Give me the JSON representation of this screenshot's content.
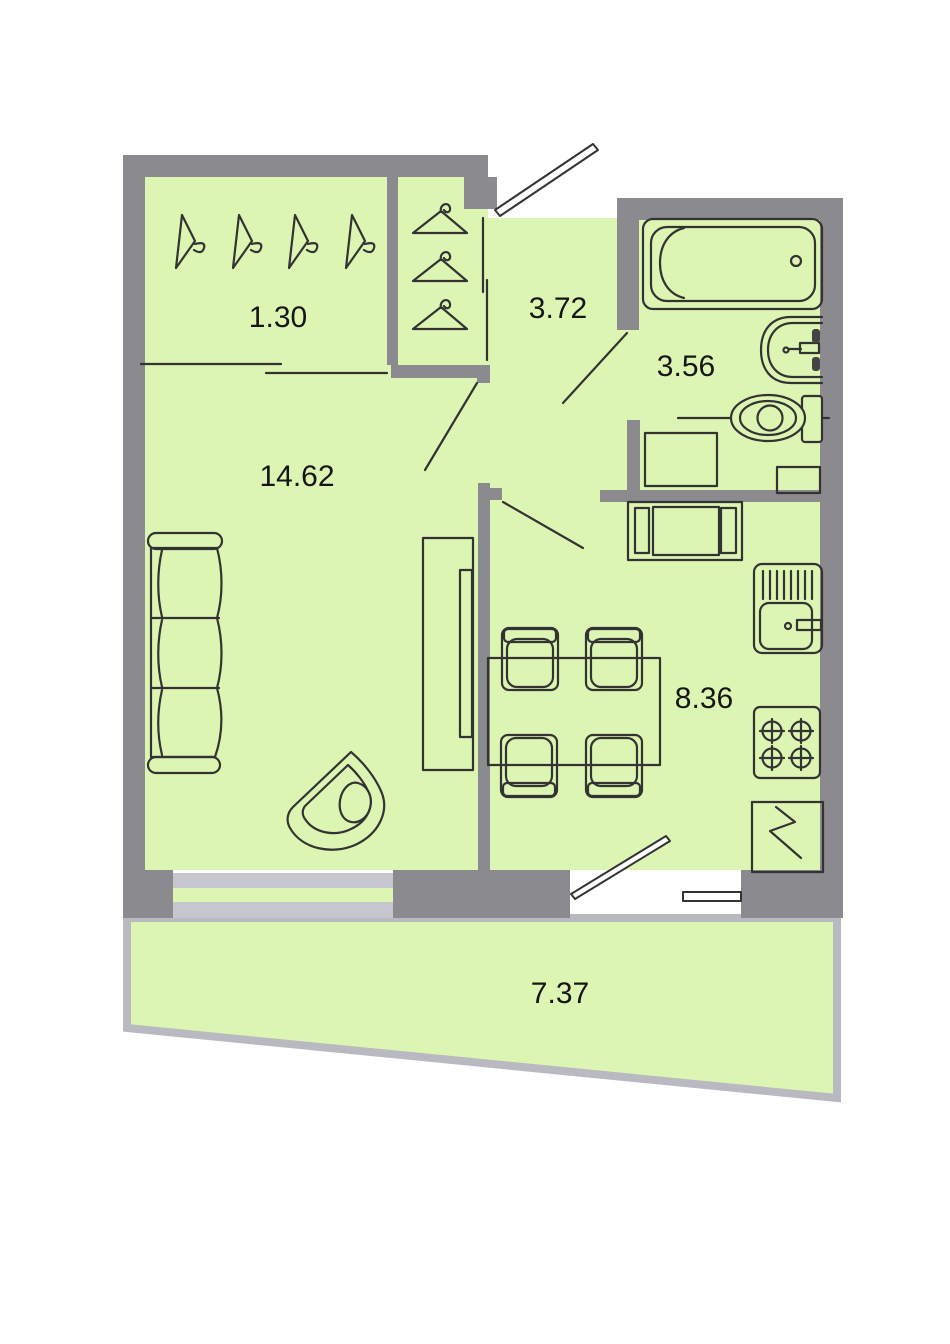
{
  "type": "apartment-floor-plan",
  "rooms": [
    {
      "name": "wardrobe",
      "area": "1.30"
    },
    {
      "name": "hallway",
      "area": "3.72"
    },
    {
      "name": "bathroom",
      "area": "3.56"
    },
    {
      "name": "living-room",
      "area": "14.62"
    },
    {
      "name": "kitchen",
      "area": "8.36"
    },
    {
      "name": "balcony",
      "area": "7.37"
    }
  ],
  "fixtures": [
    "coat-hanger-icons",
    "closet-hanger-icons",
    "bathtub",
    "washbasin",
    "toilet",
    "washing-machine",
    "bathroom-cabinet",
    "sofa",
    "armchair",
    "wardrobe-cabinet",
    "dining-table",
    "dining-chairs",
    "kitchen-bench",
    "kitchen-sink",
    "stove",
    "refrigerator",
    "entrance-door",
    "interior-doors",
    "balcony-door",
    "window"
  ],
  "colors": {
    "floor": "#dcf5b2",
    "wall": "#8b8b8f",
    "window": "#c6c6ce",
    "balcony_border": "#b9b9c1",
    "outline": "#333333",
    "label": "#161616",
    "background": "#ffffff"
  }
}
